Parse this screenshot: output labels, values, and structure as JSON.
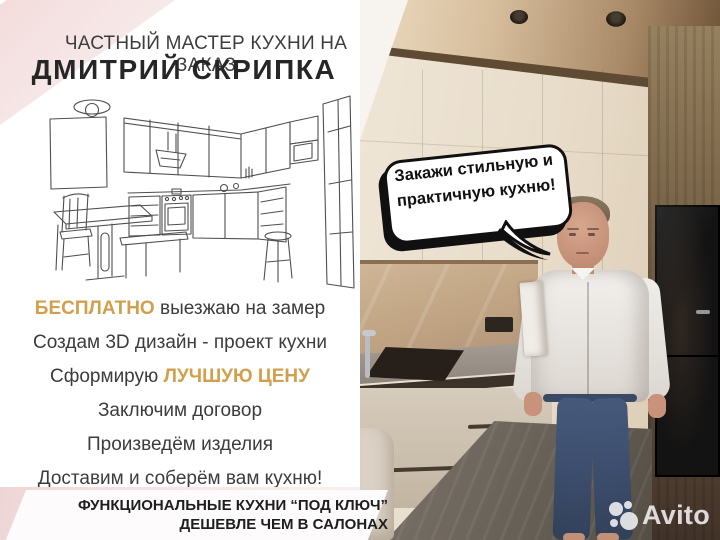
{
  "header": {
    "subtitle": "ЧАСТНЫЙ МАСТЕР КУХНИ НА ЗАКАЗ",
    "title": "ДМИТРИЙ СКРИПКА"
  },
  "benefits": {
    "line1_highlight": "БЕСПЛАТНО",
    "line1_rest": "выезжаю на замер",
    "line2": "Создам 3D дизайн - проект кухни",
    "line3_prefix": "Сформирую",
    "line3_highlight": "ЛУЧШУЮ ЦЕНУ",
    "line4": "Заключим договор",
    "line5": "Произведём изделия",
    "line6": "Доставим и соберём вам кухню!"
  },
  "footer": {
    "line1": "ФУНКЦИОНАЛЬНЫЕ КУХНИ “ПОД КЛЮЧ”",
    "line2": "ДЕШЕВЛЕ ЧЕМ В САЛОНАХ"
  },
  "speech_bubble": {
    "line1": "Закажи стильную и",
    "line2": "практичную кухню!"
  },
  "watermark": {
    "label": "Avito"
  },
  "colors": {
    "accent_gold": "#d2a04c",
    "text_dark": "#3c3c3c",
    "pink_light": "#f6e7e7",
    "bubble_outline": "#101010",
    "ceiling_wood": "#a98a68",
    "cabinet_cream": "#e9dfcf"
  }
}
